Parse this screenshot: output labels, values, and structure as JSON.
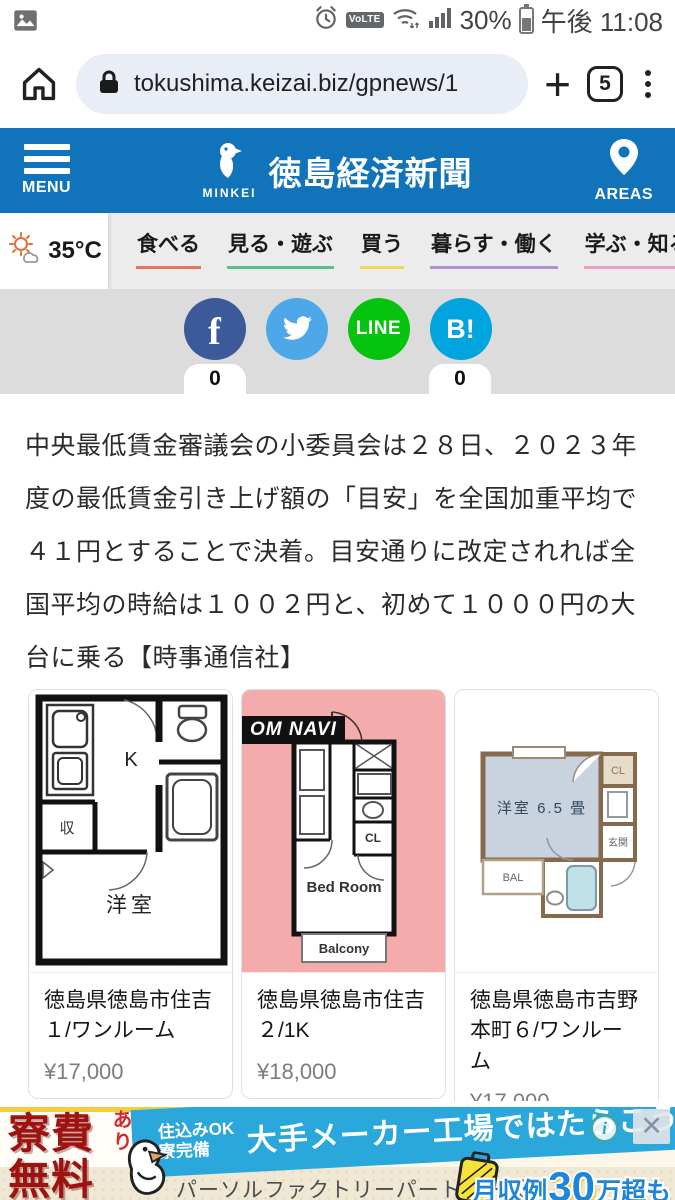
{
  "theme": {
    "header_blue": "#1173ba"
  },
  "status_bar": {
    "battery_percent": "30%",
    "time": "午後 11:08",
    "volte": "VoLTE"
  },
  "browser": {
    "url": "tokushima.keizai.biz/gpnews/1",
    "tab_count": "5"
  },
  "site_header": {
    "menu_label": "MENU",
    "logo_sub": "MINKEI",
    "title": "徳島経済新聞",
    "areas_label": "AREAS"
  },
  "weather": {
    "temp": "35°C"
  },
  "nav": {
    "items": [
      {
        "label": "食べる",
        "color": "#e4755c"
      },
      {
        "label": "見る・遊ぶ",
        "color": "#5bbd8b"
      },
      {
        "label": "買う",
        "color": "#ecd95a"
      },
      {
        "label": "暮らす・働く",
        "color": "#b58fd0"
      },
      {
        "label": "学ぶ・知る",
        "color": "#ef9ec6"
      }
    ]
  },
  "share": {
    "facebook": {
      "glyph": "f",
      "color": "#3c5a99",
      "count": "0"
    },
    "twitter": {
      "color": "#4da7e8"
    },
    "line": {
      "label": "LINE",
      "color": "#06c30f"
    },
    "hatena": {
      "glyph": "B!",
      "color": "#00a4de",
      "count": "0"
    }
  },
  "article": {
    "body": "中央最低賃金審議会の小委員会は２８日、２０２３年度の最低賃金引き上げ額の「目安」を全国加重平均で４１円とすることで決着。目安通りに改定されれば全国平均の時給は１００２円と、初めて１０００円の大台に乗る【時事通信社】"
  },
  "listings": [
    {
      "location": "徳島県徳島市住吉１/ワンルーム",
      "price": "¥17,000",
      "plan": {
        "kitchen": "K",
        "closet": "収",
        "room": "洋室"
      }
    },
    {
      "location": "徳島県徳島市住吉２/1K",
      "price": "¥18,000",
      "watermark": "OM NAVI",
      "plan": {
        "cl": "CL",
        "bedroom": "Bed Room",
        "balcony": "Balcony"
      }
    },
    {
      "location": "徳島県徳島市吉野本町６/ワンルーム",
      "price": "¥17,000",
      "plan": {
        "room": "洋室 6.5 畳",
        "cl": "CL",
        "genkan": "玄関",
        "bal": "BAL"
      }
    }
  ],
  "ad": {
    "free_line1": "寮費",
    "free_line2": "無料",
    "ari": "あり",
    "cond1": "住込みOK",
    "cond2": "寮完備",
    "headline": "大手メーカー工場ではたらこう",
    "company": "パーソルファクトリーパートナーズ",
    "income_prefix": "月収例",
    "income_number": "30",
    "income_suffix": "万超も",
    "info_glyph": "i",
    "close_glyph": "✕",
    "blue": "#2aa7db",
    "red": "#9e1212"
  }
}
